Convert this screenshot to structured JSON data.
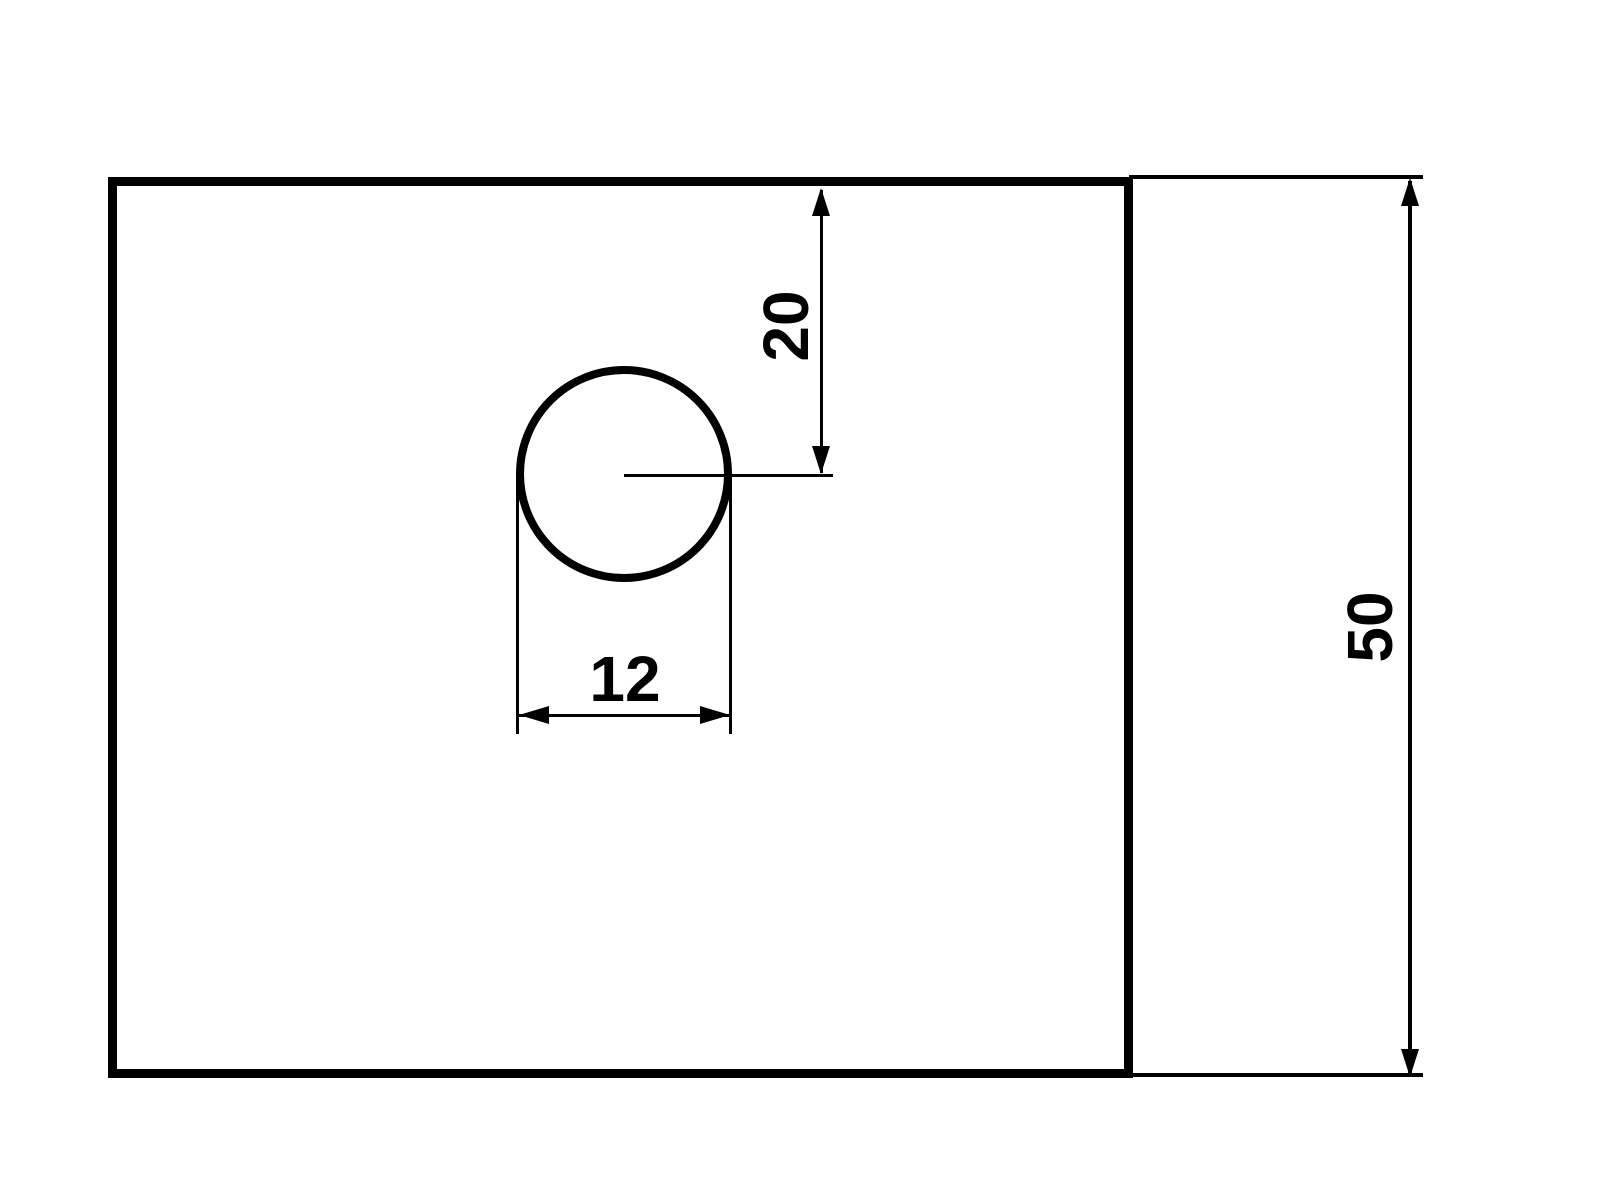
{
  "drawing": {
    "type": "technical-drawing",
    "background_color": "#ffffff",
    "line_color": "#000000",
    "shapes": {
      "plate": "rectangular plate outline",
      "hole": "circular hole"
    },
    "dimensions": {
      "hole_offset_from_top": {
        "label": "20"
      },
      "hole_diameter": {
        "label": "12"
      },
      "plate_height": {
        "label": "50"
      }
    }
  }
}
